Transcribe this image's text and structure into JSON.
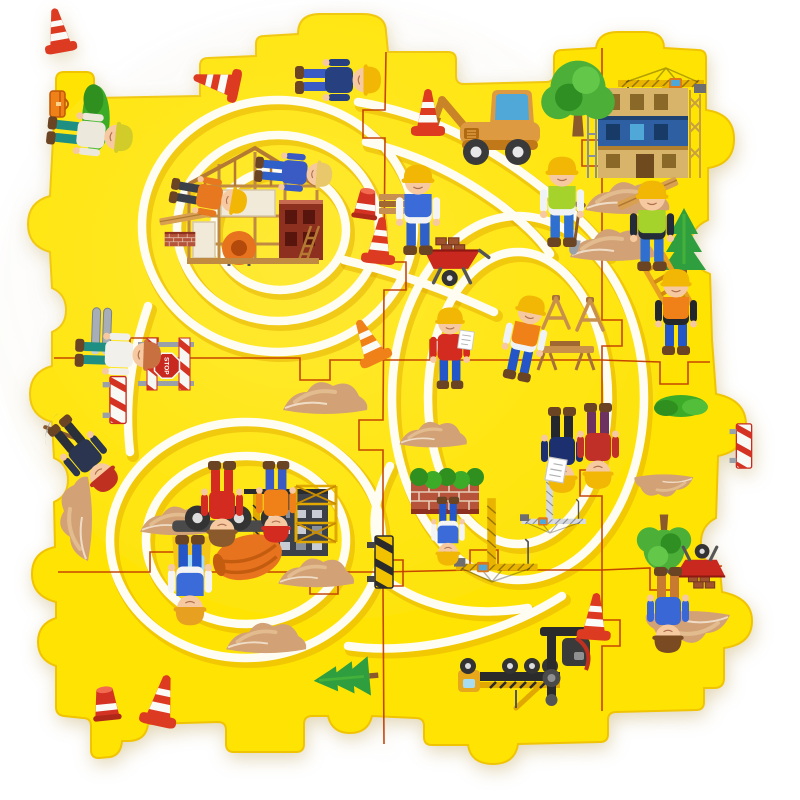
{
  "scene": {
    "description": "yellow foam 3x3 puzzle play mat, construction theme, grooved vehicle track",
    "stop_sign_label": "STOP",
    "colors": {
      "background": "#FFFFFF",
      "mat": "#FFE403",
      "mat_edge": "#F0C400",
      "track": "#FFFDF2",
      "track_shadow": "#DFA600",
      "seam": "#C23D00",
      "sheen": "#FFFFFF"
    },
    "grid": {
      "rows": 3,
      "cols": 3
    },
    "outline_path": "M 56 100 L 56 80 Q 56 72 64 72 L 86 72 Q 94 72 94 80 L 94 98 L 200 96 L 200 66 Q 200 58 208 58 L 256 56 L 256 44 Q 256 36 264 36 L 298 34 Q 298 14 320 14 L 362 14 Q 386 14 386 32 L 388 52 L 448 52 Q 456 52 456 60 L 456 76 Q 456 84 464 84 L 546 82 Q 554 82 554 74 L 554 58 Q 554 50 562 50 L 596 48 Q 598 32 618 32 L 644 32 Q 664 32 664 48 L 698 50 Q 706 50 706 58 L 706 110 Q 734 114 734 139 Q 734 164 708 168 L 708 220 Q 690 228 690 247 Q 690 266 710 274 L 712 340 L 716 394 Q 746 400 746 425 Q 746 450 718 456 L 716 518 Q 700 526 701 545 Q 702 564 720 570 L 722 592 Q 752 598 752 621 Q 752 644 724 648 L 724 678 Q 724 688 714 688 L 704 688 L 704 702 Q 704 710 696 710 L 616 712 Q 608 712 608 720 L 608 734 Q 608 742 600 742 L 518 744 Q 515 764 493 764 Q 471 764 468 745 L 432 745 Q 424 745 424 737 L 424 726 Q 424 718 416 718 L 372 716 Q 368 733 350 733 Q 332 733 328 716 L 312 716 Q 304 716 304 724 L 304 744 Q 304 752 296 752 L 234 752 Q 226 752 226 744 L 226 730 Q 226 722 218 722 L 148 724 Q 146 741 128 741 L 122 741 Q 121 755 110 757 L 99 758 Q 91 758 91 750 L 91 726 Q 91 718 83 718 L 64 716 Q 56 715 56 707 L 56 666 Q 38 660 38 642 Q 38 624 56 618 L 56 602 Q 32 596 32 574 Q 32 552 55 547 L 54 502 Q 68 496 68 480 Q 68 464 54 458 L 52 422 Q 30 416 30 394 Q 30 372 52 366 L 52 332 Q 66 326 66 310 Q 66 294 52 288 L 50 252 Q 28 246 28 224 Q 28 202 50 196 L 52 158 L 54 120 Q 54 106 56 100 Z",
    "seam_paths": [
      {
        "name": "vertical-1",
        "d": "M 386 52 L 385 110 L 363 110 L 363 138 L 385 138 L 384 262 L 406 262 L 406 290 L 384 290 L 383 420 L 359 420 L 359 450 L 383 450 L 383 560 L 403 560 L 403 586 L 383 586 L 384 744"
      },
      {
        "name": "vertical-2",
        "d": "M 602 48 L 602 140 L 582 140 L 582 166 L 602 166 L 602 320 L 622 320 L 622 346 L 602 346 L 602 470 L 580 470 L 580 496 L 602 496 L 602 620 L 620 620 L 620 646 L 602 646 L 602 711"
      },
      {
        "name": "horizontal-1",
        "d": "M 54 358 L 130 358 L 130 338 L 158 338 L 158 358 L 300 358 L 300 380 L 330 380 L 330 360 L 383 360 L 430 360 L 430 340 L 458 340 L 458 360 L 602 360 L 660 362 L 660 384 L 688 384 L 688 362 L 710 362"
      },
      {
        "name": "horizontal-2",
        "d": "M 58 572 L 150 572 L 150 552 L 178 552 L 178 572 L 310 572 L 310 594 L 338 594 L 338 572 L 383 572 L 470 570 L 470 550 L 498 550 L 498 570 L 602 570 L 650 568 L 650 590 L 678 590 L 678 568 L 722 566"
      }
    ],
    "track_paths": [
      {
        "name": "spiral-outer",
        "d": "M 142 226 a 136 126 0 1 0 272 0 a 136 126 0 1 0 -272 0"
      },
      {
        "name": "spiral-middle",
        "d": "M 177 228 a 101 93 0 1 0 202 0 a 101 93 0 1 0 -202 0"
      },
      {
        "name": "spiral-inner",
        "d": "M 214 230 a 66 60 0 1 0 132 0 a 66 60 0 1 0 -132 0"
      },
      {
        "name": "right-loop-outer",
        "d": "M 392 398 a 126 182 0 1 0 252 0 a 126 182 0 1 0 -252 0"
      },
      {
        "name": "right-loop-inner",
        "d": "M 428 398 a 90 146 0 1 0 180 0 a 90 146 0 1 0 -180 0"
      },
      {
        "name": "left-oval-outer",
        "d": "M 110 540 a 136 118 0 1 0 272 0 a 136 118 0 1 0 -272 0"
      },
      {
        "name": "left-oval-inner",
        "d": "M 146 540 a 100 84 0 1 0 200 0 a 100 84 0 1 0 -200 0"
      },
      {
        "name": "top-link",
        "d": "M 358 102 C 430 114 484 144 532 180 C 566 206 592 228 608 254"
      },
      {
        "name": "top-link-inner",
        "d": "M 366 142 C 424 156 464 178 502 206 C 522 222 538 236 550 254"
      },
      {
        "name": "left-link",
        "d": "M 148 306 C 132 354 124 400 130 452"
      },
      {
        "name": "center-link",
        "d": "M 344 260 C 402 274 446 290 494 312"
      },
      {
        "name": "neck-link",
        "d": "M 390 466 C 374 498 370 526 380 556"
      },
      {
        "name": "bottom-link-a",
        "d": "M 378 574 C 418 606 468 618 528 608"
      },
      {
        "name": "bottom-link-b",
        "d": "M 348 646 C 420 656 502 634 562 596"
      }
    ],
    "items": [
      {
        "t": "sand",
        "n": "sand-pile",
        "x": 627,
        "y": 196
      },
      {
        "t": "sand",
        "n": "sand-pile",
        "x": 612,
        "y": 243
      },
      {
        "t": "sand",
        "n": "sand-pile",
        "x": 325,
        "y": 396
      },
      {
        "t": "sand",
        "n": "sand-pile",
        "x": 433,
        "y": 433,
        "s": 0.8
      },
      {
        "t": "sand",
        "n": "sand-pile",
        "x": 74,
        "y": 519,
        "r": -90
      },
      {
        "t": "sand",
        "n": "sand-pile",
        "x": 178,
        "y": 519,
        "s": 0.9
      },
      {
        "t": "sand",
        "n": "sand-pile",
        "x": 316,
        "y": 571,
        "s": 0.9
      },
      {
        "t": "sand",
        "n": "sand-pile",
        "x": 266,
        "y": 636,
        "s": 0.95
      },
      {
        "t": "sand",
        "n": "sand-pile-inverted",
        "x": 688,
        "y": 629,
        "r": 180
      },
      {
        "t": "sand",
        "n": "sand-pile-inverted",
        "x": 664,
        "y": 487,
        "r": 180,
        "s": 0.7
      },
      {
        "t": "tower-crane",
        "n": "tower-crane",
        "x": 666,
        "y": 112
      },
      {
        "t": "building-blue",
        "n": "construction-building",
        "x": 644,
        "y": 134
      },
      {
        "t": "house-frame",
        "n": "timber-frame-house",
        "x": 255,
        "y": 214
      },
      {
        "t": "excavator",
        "n": "excavator-digger",
        "x": 500,
        "y": 130
      },
      {
        "t": "tree-round",
        "n": "leafy-tree",
        "x": 578,
        "y": 102,
        "s": 1.15
      },
      {
        "t": "conifer",
        "n": "conifer-tree",
        "x": 684,
        "y": 244
      },
      {
        "t": "bush",
        "n": "bush",
        "x": 681,
        "y": 406
      },
      {
        "t": "bush",
        "n": "bush-sideways",
        "x": 96,
        "y": 118,
        "r": 90,
        "s": 1.25
      },
      {
        "t": "conifer",
        "n": "conifer-tree-sideways",
        "x": 346,
        "y": 678,
        "r": -95,
        "s": 0.9
      },
      {
        "t": "tree-round",
        "n": "leafy-tree-inverted",
        "x": 664,
        "y": 540,
        "r": 180,
        "s": 0.85
      },
      {
        "t": "building-dark",
        "n": "building-silhouette-inverted",
        "x": 286,
        "y": 524,
        "r": 180
      },
      {
        "t": "scaffold",
        "n": "scaffold-tower-inverted",
        "x": 316,
        "y": 514,
        "r": 180
      },
      {
        "t": "tower-crane",
        "n": "tower-crane-inverted",
        "x": 492,
        "y": 540,
        "r": 180,
        "s": 0.95
      },
      {
        "t": "tower-crane",
        "n": "lattice-crane-inverted",
        "x": 550,
        "y": 500,
        "r": 180,
        "s": 0.75,
        "vars": {
          "--cr": "#D6DAE0"
        }
      },
      {
        "t": "mixer-truck",
        "n": "cement-mixer-truck-inverted",
        "x": 232,
        "y": 548,
        "r": 180,
        "s": 1.15
      },
      {
        "t": "flatbed-truck",
        "n": "flatbed-truck-inverted",
        "x": 508,
        "y": 674,
        "r": 180
      },
      {
        "t": "drill-rig",
        "n": "drill-rig-inverted",
        "x": 564,
        "y": 658,
        "r": 180
      },
      {
        "t": "brick-wall",
        "n": "brick-wall-inverted",
        "x": 445,
        "y": 496,
        "r": 180
      },
      {
        "t": "bush-strip",
        "n": "hedge-strip-inverted",
        "x": 447,
        "y": 477,
        "r": 180
      },
      {
        "t": "brick-wall",
        "n": "brick-stack",
        "x": 180,
        "y": 240,
        "s": 0.45
      },
      {
        "t": "plank",
        "n": "wood-pallet",
        "x": 185,
        "y": 218,
        "r": -10,
        "s": 0.8
      },
      {
        "t": "stop-barrier",
        "n": "stop-sign-barrier",
        "x": 166,
        "y": 364,
        "r": 90
      },
      {
        "t": "pipes",
        "n": "metal-pipes",
        "x": 102,
        "y": 330,
        "r": 92
      },
      {
        "t": "toolbox",
        "n": "toolbox",
        "x": 58,
        "y": 104,
        "r": 90
      },
      {
        "t": "barrier-striped",
        "n": "striped-barrier",
        "x": 118,
        "y": 400,
        "r": 90,
        "s": 0.9
      },
      {
        "t": "barrier-hazard",
        "n": "hazard-barrier-sideways",
        "x": 384,
        "y": 562,
        "r": 90
      },
      {
        "t": "barrier-striped",
        "n": "striped-barrier-sideways",
        "x": 744,
        "y": 446,
        "r": 90,
        "s": 0.85
      },
      {
        "t": "wheelbarrow",
        "n": "brick-wheelbarrow",
        "x": 452,
        "y": 262,
        "s": 1.15
      },
      {
        "t": "wheelbarrow",
        "n": "brick-wheelbarrow-inverted",
        "x": 700,
        "y": 566,
        "r": 180,
        "s": 1.05
      },
      {
        "t": "planks-stack",
        "n": "lumber-stack",
        "x": 396,
        "y": 204
      },
      {
        "t": "saw-table",
        "n": "saw-table",
        "x": 566,
        "y": 354
      },
      {
        "t": "sawhorse-a",
        "n": "sawhorse",
        "x": 556,
        "y": 314
      },
      {
        "t": "sawhorse-a",
        "n": "sawhorse",
        "x": 590,
        "y": 316
      },
      {
        "t": "ladder",
        "n": "ladder",
        "x": 668,
        "y": 286,
        "r": -30
      },
      {
        "t": "plank",
        "n": "lumber-plank",
        "x": 648,
        "y": 194,
        "r": -24
      },
      {
        "t": "shovel",
        "n": "shovel",
        "x": 576,
        "y": 232,
        "r": 8
      },
      {
        "t": "pickaxe",
        "n": "pickaxe",
        "x": 64,
        "y": 434,
        "r": -70
      },
      {
        "t": "worker",
        "n": "worker-lying-corner",
        "x": 86,
        "y": 134,
        "r": 96,
        "vars": {
          "--shirt": "#EDE8DC",
          "--pants": "#1F8F83",
          "--hat": "#D2CC2A"
        }
      },
      {
        "t": "worker",
        "n": "worker-lying-top",
        "x": 334,
        "y": 80,
        "r": 90,
        "vars": {
          "--shirt": "#27407F",
          "--pants": "#3A5BC4",
          "--hat": "#F2B705"
        }
      },
      {
        "t": "worker",
        "n": "worker-on-frame-blue",
        "x": 290,
        "y": 172,
        "r": 95,
        "s": 0.9,
        "vars": {
          "--shirt": "#3A5BC4",
          "--pants": "#2F5FC8",
          "--hat": "#E8C86A"
        }
      },
      {
        "t": "worker",
        "n": "worker-on-frame-orange",
        "x": 205,
        "y": 196,
        "r": 100,
        "s": 0.9,
        "vars": {
          "--shirt": "#E87820",
          "--pants": "#3A3F48",
          "--hat": "#F2B705"
        }
      },
      {
        "t": "worker",
        "n": "worker-carrying-planks",
        "x": 418,
        "y": 214,
        "s": 1.05,
        "vars": {
          "--shirt": "#F4F4F4",
          "--vest": "#3A6BD8",
          "--pants": "#2F5FC8",
          "--hat": "#F2B705"
        }
      },
      {
        "t": "worker",
        "n": "worker-with-shovel",
        "x": 562,
        "y": 206,
        "s": 1.05,
        "vars": {
          "--shirt": "#EFF3F5",
          "--vest": "#A6D32B",
          "--pants": "#2F6FD0",
          "--hat": "#F2B705"
        }
      },
      {
        "t": "worker",
        "n": "worker-carrying-lumber",
        "x": 652,
        "y": 230,
        "s": 1.05,
        "vars": {
          "--shirt": "#232C38",
          "--vest": "#A6D32B",
          "--pants": "#2F6FD0",
          "--hat": "#F2B705"
        }
      },
      {
        "t": "worker",
        "n": "worker-carrying-ladder",
        "x": 676,
        "y": 316,
        "vars": {
          "--shirt": "#23272B",
          "--vest": "#F08018",
          "--pants": "#2456C8",
          "--hat": "#F2B705"
        }
      },
      {
        "t": "worker",
        "n": "worker-with-clipboard",
        "x": 450,
        "y": 352,
        "s": 0.95,
        "vars": {
          "--shirt": "#D42B20",
          "--pants": "#2456C8",
          "--hat": "#F2B705"
        }
      },
      {
        "t": "worker",
        "n": "worker-sawing",
        "x": 524,
        "y": 342,
        "r": 12,
        "vars": {
          "--shirt": "#EFF3F5",
          "--vest": "#F08018",
          "--pants": "#2456C8",
          "--hat": "#F2B705"
        }
      },
      {
        "t": "worker",
        "n": "worker-lying-pipes",
        "x": 114,
        "y": 354,
        "r": 92,
        "vars": {
          "--shirt": "#F2F0EA",
          "--pants": "#1F8F83",
          "--hat": "#C87040"
        }
      },
      {
        "t": "worker",
        "n": "worker-with-pickaxe-sideways",
        "x": 82,
        "y": 452,
        "r": 140,
        "vars": {
          "--shirt": "#2B3550",
          "--pants": "#2B2F38",
          "--hat": "#C03020"
        }
      },
      {
        "t": "worker",
        "n": "worker-red-suit-inverted",
        "x": 222,
        "y": 500,
        "r": 180,
        "vars": {
          "--shirt": "#D42B20",
          "--pants": "#D42B20",
          "--hat": "#8A5A2C"
        }
      },
      {
        "t": "worker",
        "n": "worker-red-cap-inverted",
        "x": 276,
        "y": 498,
        "r": 180,
        "s": 0.95,
        "vars": {
          "--shirt": "#F08018",
          "--pants": "#3A5BC4",
          "--hat": "#D42B20"
        }
      },
      {
        "t": "worker",
        "n": "worker-overalls-inverted",
        "x": 190,
        "y": 576,
        "r": 180,
        "s": 1.05,
        "vars": {
          "--shirt": "#F4F4F4",
          "--vest": "#3A6BD8",
          "--pants": "#2456C8",
          "--hat": "#E8A020"
        }
      },
      {
        "t": "worker",
        "n": "boy-at-brick-wall-inverted",
        "x": 448,
        "y": 528,
        "r": 180,
        "s": 0.8,
        "vars": {
          "--shirt": "#F4F4F4",
          "--vest": "#3A6BD8",
          "--pants": "#2456C8",
          "--hat": "#F2B705"
        }
      },
      {
        "t": "worker",
        "n": "engineer-inverted",
        "x": 562,
        "y": 446,
        "r": 180,
        "vars": {
          "--shirt": "#1C2F6E",
          "--pants": "#24282E",
          "--hat": "#F2B705"
        }
      },
      {
        "t": "worker",
        "n": "worker-with-papers-inverted",
        "x": 598,
        "y": 442,
        "r": 180,
        "vars": {
          "--shirt": "#C03028",
          "--pants": "#6E3260",
          "--hat": "#F2B705"
        }
      },
      {
        "t": "worker",
        "n": "wheelbarrow-worker-inverted",
        "x": 668,
        "y": 606,
        "r": 180,
        "vars": {
          "--shirt": "#3A67D6",
          "--pants": "#C87A30",
          "--hat": "#7A4A22"
        }
      },
      {
        "t": "paper",
        "n": "clipboard-paper",
        "x": 466,
        "y": 340,
        "r": 8,
        "s": 0.9
      },
      {
        "t": "paper",
        "n": "blueprint-paper-inverted",
        "x": 556,
        "y": 470,
        "r": 190,
        "s": 1.15
      },
      {
        "t": "cone",
        "n": "traffic-cone-tipped",
        "x": 216,
        "y": 82,
        "r": -78
      },
      {
        "t": "cone",
        "n": "traffic-cone",
        "x": 428,
        "y": 112
      },
      {
        "t": "bucket-cone",
        "n": "cone-stub",
        "x": 366,
        "y": 204,
        "r": 8
      },
      {
        "t": "cone",
        "n": "traffic-cone",
        "x": 380,
        "y": 240,
        "r": 6
      },
      {
        "t": "cone",
        "n": "traffic-cone-orange-tipped",
        "x": 368,
        "y": 341,
        "r": -25,
        "vars": {
          "--c1": "#F08018"
        }
      },
      {
        "t": "cone",
        "n": "traffic-cone",
        "x": 162,
        "y": 700,
        "r": 12,
        "s": 1.1
      },
      {
        "t": "bucket-cone",
        "n": "cone-stub",
        "x": 106,
        "y": 704,
        "r": -6,
        "s": 1.1
      },
      {
        "t": "cone",
        "n": "traffic-cone",
        "x": 595,
        "y": 616,
        "r": 4
      },
      {
        "t": "cone",
        "n": "traffic-cone-loose",
        "x": 58,
        "y": 30,
        "r": -10,
        "s": 0.95
      }
    ]
  }
}
